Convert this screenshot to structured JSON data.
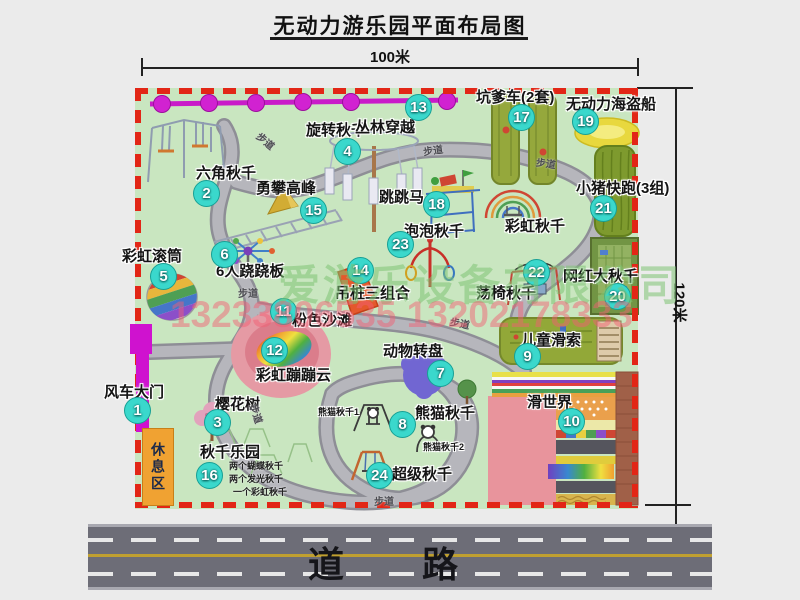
{
  "title": "无动力游乐园平面布局图",
  "dims": {
    "width": "100米",
    "height": "120米"
  },
  "road": {
    "label": "道 路"
  },
  "park": {
    "rest_area": "休息区",
    "trail_label": "步道",
    "rainbow_swing_label": "彩虹秋千",
    "notes": {
      "panda1": "熊猫秋千1",
      "panda2": "熊猫秋千2",
      "swing_park": [
        "两个蝴蝶秋千",
        "两个发光秋千",
        "一个彩虹秋千"
      ]
    },
    "attractions": [
      {
        "num": "1",
        "name": "风车大门"
      },
      {
        "num": "2",
        "name": "六角秋千"
      },
      {
        "num": "3",
        "name": "樱花树"
      },
      {
        "num": "4",
        "name": "旋转秋千"
      },
      {
        "num": "5",
        "name": "彩虹滚筒"
      },
      {
        "num": "6",
        "name": "6人跷跷板"
      },
      {
        "num": "7",
        "name": "动物转盘"
      },
      {
        "num": "8",
        "name": "熊猫秋千"
      },
      {
        "num": "9",
        "name": "儿童滑索"
      },
      {
        "num": "10",
        "name": "滑世界"
      },
      {
        "num": "11",
        "name": "粉色沙滩"
      },
      {
        "num": "12",
        "name": "彩虹蹦蹦云"
      },
      {
        "num": "13",
        "name": "丛林穿越"
      },
      {
        "num": "14",
        "name": "吊桩三组合"
      },
      {
        "num": "15",
        "name": "勇攀高峰"
      },
      {
        "num": "16",
        "name": "秋千乐园"
      },
      {
        "num": "17",
        "name": "坑爹车(2套)"
      },
      {
        "num": "18",
        "name": "跳跳马"
      },
      {
        "num": "19",
        "name": "无动力海盗船"
      },
      {
        "num": "20",
        "name": "网红大秋千"
      },
      {
        "num": "21",
        "name": "小猪快跑(3组)"
      },
      {
        "num": "22",
        "name": "荡椅秋千"
      },
      {
        "num": "23",
        "name": "泡泡秋千"
      },
      {
        "num": "24",
        "name": "超级秋千"
      }
    ]
  },
  "watermark": {
    "company": "爱游乐设备有限公司",
    "phone": "13233806535 13202178333"
  },
  "colors": {
    "park_green": "#c9e6c0",
    "border_red": "#e22616",
    "badge_cyan": "#3ad8cc",
    "road_gray": "#6d6d77",
    "gate_magenta": "#cf12cf",
    "zipline_magenta": "#c91bc9",
    "rest_orange": "#f0a232",
    "path_gray": "#b3b3b9"
  }
}
